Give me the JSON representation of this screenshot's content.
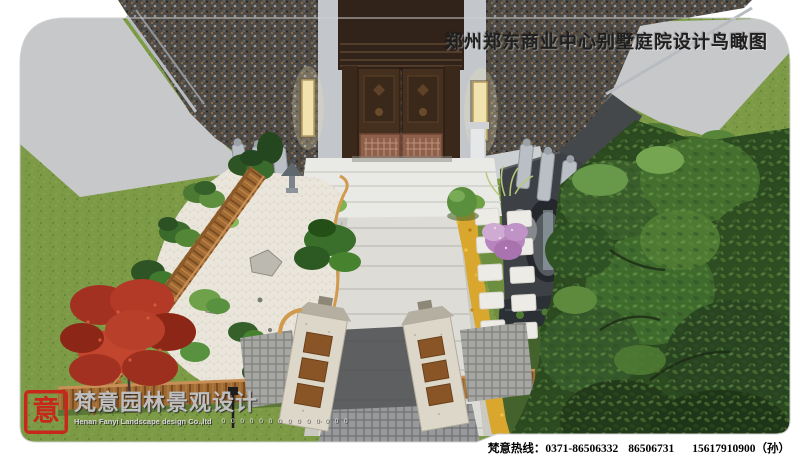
{
  "header": {
    "title": "郑州郑东商业中心别墅庭院设计鸟瞰图"
  },
  "footer": {
    "hotline_label": "梵意热线：",
    "phones": [
      "0371-86506332",
      "86506731",
      "15617910900（孙）"
    ]
  },
  "logo": {
    "seal_char": "意",
    "company_cn": "梵意园林景观设计",
    "company_en": "Henan Fanyi Landscape design Co.,ltd",
    "digits": "0 0 0 0 0 0 0 0 0 0 0 0 0 0"
  },
  "scene": {
    "description": "别墅入口庭院景观设计鸟瞰效果图",
    "elements": [
      "granite-facade",
      "entrance-double-door",
      "wall-lamps",
      "entry-steps",
      "stone-sculptures",
      "zen-gravel-garden",
      "garden-rocks",
      "stone-lantern",
      "wood-fence",
      "red-maple-tree",
      "pine-shrubs",
      "main-stone-walkway",
      "gate-pillars",
      "lattice-paving",
      "yellow-flower-bed",
      "stepping-stones",
      "round-topiary",
      "pink-flowering-shrub",
      "water-feature-moon-wall",
      "large-trees",
      "bamboo",
      "lawn",
      "garden-lamp"
    ]
  },
  "palette": {
    "seal_red": "#c8281c",
    "title_color": "#1f1f1f",
    "hotline_color": "#000000",
    "logo_gray": "#bfbfbf",
    "page_bg": "#ffffff",
    "sky_gray": "#c7c8ca",
    "lawn_green": "#7d9b46",
    "granite_dark": "#4e4a45",
    "door_brown": "#45301f",
    "copper": "#8e5f49",
    "gravel_white": "#e9e5da",
    "walkway_gray": "#dedcd6",
    "wood_fence": "#9c6630",
    "maple_red": "#a83226",
    "tree_dark_green": "#2e4d22",
    "flower_yellow": "#d9a62e",
    "shrub_pink": "#b784bd"
  }
}
